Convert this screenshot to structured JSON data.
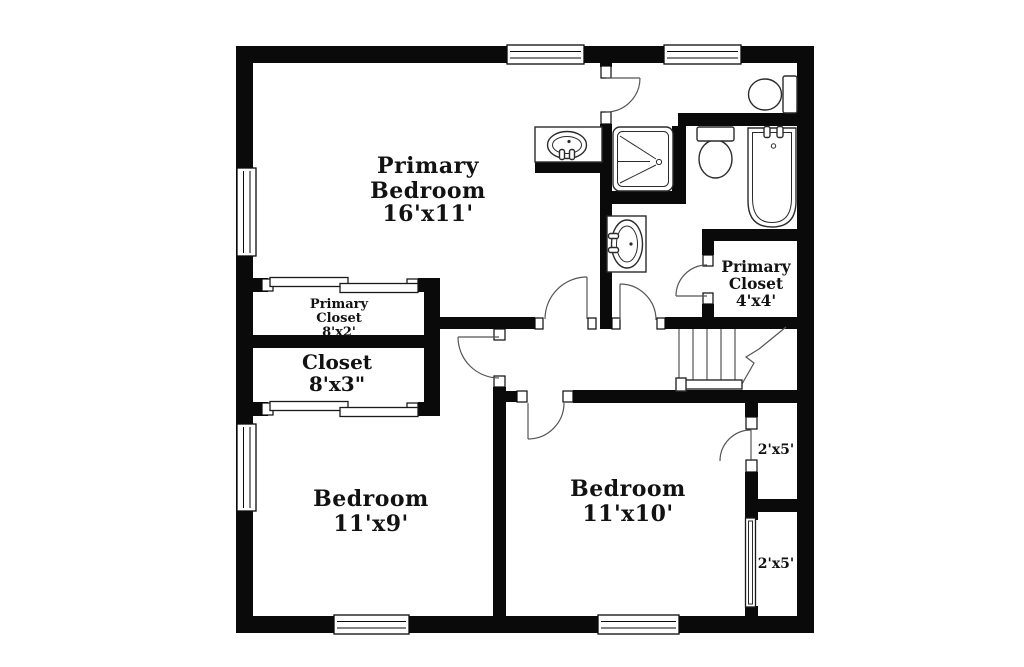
{
  "colors": {
    "wall": "#0a0a0a",
    "background": "#ffffff",
    "line": "#2b2b2b",
    "text": "#121212"
  },
  "rooms": {
    "primary_bedroom": {
      "name": "Primary Bedroom",
      "size": "16'x11'",
      "lines": [
        "Primary",
        "Bedroom",
        "16'x11'"
      ]
    },
    "primary_closet_upper": {
      "name": "Primary Closet",
      "size": "8'x2'",
      "lines": [
        "Primary",
        "Closet",
        "8'x2'"
      ]
    },
    "closet": {
      "name": "Closet",
      "size": "8'x3\"",
      "lines": [
        "Closet",
        "8'x3\""
      ]
    },
    "bedroom_left": {
      "name": "Bedroom",
      "size": "11'x9'",
      "lines": [
        "Bedroom",
        "11'x9'"
      ]
    },
    "bedroom_right": {
      "name": "Bedroom",
      "size": "11'x10'",
      "lines": [
        "Bedroom",
        "11'x10'"
      ]
    },
    "primary_closet_bath": {
      "name": "Primary Closet",
      "size": "4'x4'",
      "lines": [
        "Primary",
        "Closet",
        "4'x4'"
      ]
    },
    "closet_right_upper": {
      "name": "Closet",
      "size": "2'x5'",
      "lines": [
        "2'x5'"
      ]
    },
    "closet_right_lower": {
      "name": "Closet",
      "size": "2'x5'",
      "lines": [
        "2'x5'"
      ]
    }
  },
  "fixtures": {
    "bathtub": "bathtub",
    "shower": "shower",
    "toilet_water_closet": "toilet",
    "toilet_main": "toilet",
    "sink_vanity_bedroom": "sink-vanity",
    "sink_vanity_bath": "sink-vanity",
    "stairs": "stairs"
  }
}
